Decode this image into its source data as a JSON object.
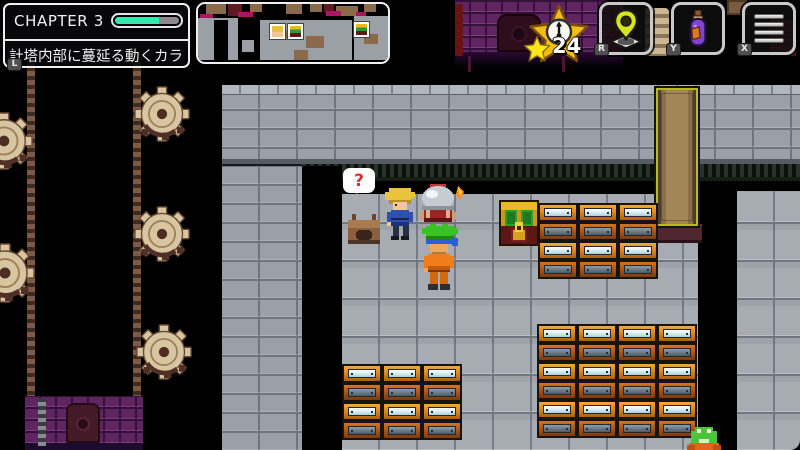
{
  "hud": {
    "chapter_panel": {
      "title": "CHAPTER 3",
      "progress_percent": 69,
      "objective_text": "計塔内部に蔓延る動くカラ",
      "hint_key": "L"
    },
    "minimap": {
      "markers": [
        "player",
        "treasure-chest",
        "treasure-chest"
      ]
    },
    "star_counter": {
      "count": "24",
      "icon": "star-clock-emblem",
      "small_icon": "star"
    },
    "action_buttons": [
      {
        "hint_key": "R",
        "icon": "map-pin"
      },
      {
        "hint_key": "Y",
        "icon": "potion-bottle"
      },
      {
        "hint_key": "X",
        "icon": "menu-bars"
      }
    ],
    "colors": {
      "progress_fill": "#35e8ac",
      "progress_rest": "#8f8a8e",
      "star_gold": "#f2bd16",
      "pin_yellow": "#d7e51f",
      "potion_purple": "#7f43cf"
    }
  },
  "scene": {
    "speech_bubble": {
      "symbol": "?"
    },
    "sprites": [
      "blonde-npc",
      "hero-carrying-machine",
      "small-stove",
      "treasure-chest",
      "frog-creature",
      "gears",
      "clock-shaft",
      "golden-door",
      "file-cabinets"
    ],
    "cabinet_cell": {
      "w": 40,
      "pair_h": 38
    },
    "cabinet_groups": [
      {
        "x": 538,
        "y": 203,
        "cols": 3,
        "rows": 2
      },
      {
        "x": 342,
        "y": 364,
        "cols": 3,
        "rows": 2
      },
      {
        "x": 537,
        "y": 324,
        "cols": 4,
        "rows": 3
      }
    ]
  }
}
